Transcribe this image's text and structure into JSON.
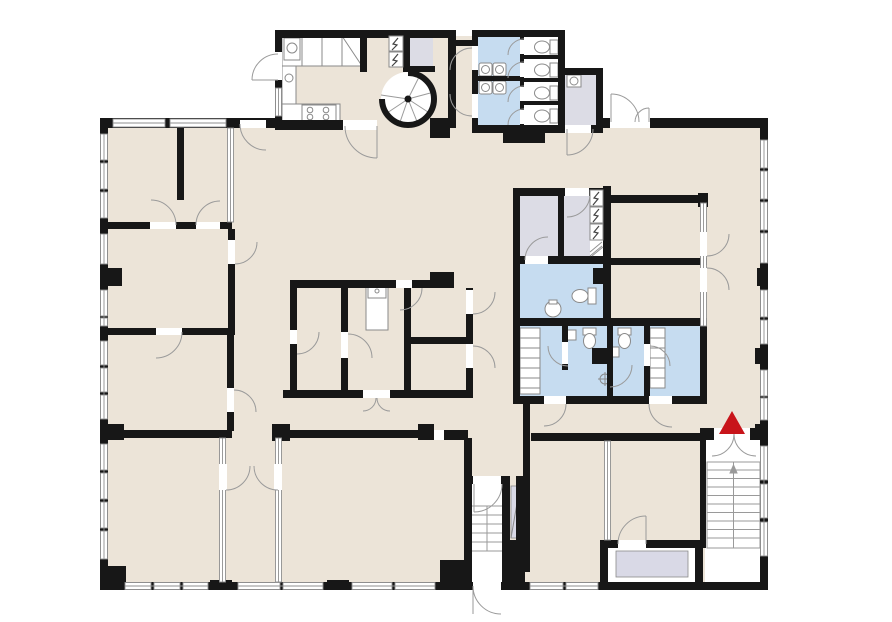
{
  "meta": {
    "title": "Building floor plan",
    "kind": "architectural-floor-plan",
    "width_px": 892,
    "height_px": 622
  },
  "colors": {
    "background": "#ffffff",
    "floor": "#ece4d8",
    "wall": "#171717",
    "wet": "#c6dcf0",
    "service": "#dcdce5",
    "mat": "#d9d9e6",
    "window_frame": "#8f8f8f",
    "door_swing": "#9a9a9a",
    "stair_line": "#9a9a9a",
    "fixture_line": "#8a8a8a",
    "marker": "#c8141a"
  },
  "legend": {
    "rooms": [
      {
        "id": "kitchen",
        "type": "kitchen",
        "fill_key": "floor"
      },
      {
        "id": "spiral-stair-hall",
        "type": "circulation",
        "fill_key": "floor"
      },
      {
        "id": "utility-closet-top",
        "type": "service",
        "fill_key": "service"
      },
      {
        "id": "washroom-a",
        "type": "wet-room",
        "fill_key": "wet"
      },
      {
        "id": "washroom-b",
        "type": "wet-room",
        "fill_key": "wet"
      },
      {
        "id": "wc-stalls",
        "type": "wc",
        "count": 4,
        "fill_key": "background"
      },
      {
        "id": "janitor-room",
        "type": "service",
        "fill_key": "service"
      },
      {
        "id": "offices-west",
        "type": "rooms",
        "fill_key": "floor"
      },
      {
        "id": "central-room-block",
        "type": "rooms",
        "fill_key": "floor"
      },
      {
        "id": "storage-a",
        "type": "service",
        "fill_key": "service"
      },
      {
        "id": "storage-b",
        "type": "service",
        "fill_key": "service"
      },
      {
        "id": "wc-room-central",
        "type": "wet-room",
        "fill_key": "wet"
      },
      {
        "id": "shower-suite",
        "type": "wet-room",
        "fill_key": "wet"
      },
      {
        "id": "main-hall",
        "type": "open-space",
        "fill_key": "floor"
      },
      {
        "id": "south-rooms",
        "type": "rooms",
        "fill_key": "floor"
      },
      {
        "id": "entry-vestibule",
        "type": "circulation",
        "fill_key": "background"
      },
      {
        "id": "elevator-room",
        "type": "service",
        "fill_key": "background"
      },
      {
        "id": "main-stairwell",
        "type": "circulation",
        "fill_key": "background"
      }
    ],
    "symbols": [
      {
        "id": "entrance-marker",
        "shape": "triangle",
        "color_key": "marker"
      },
      {
        "id": "spiral-staircase",
        "shape": "spiral-stair"
      },
      {
        "id": "main-stairs",
        "shape": "straight-stair"
      },
      {
        "id": "vestibule-stairs",
        "shape": "straight-stair"
      },
      {
        "id": "electrical-panel",
        "shape": "lightning-bolt",
        "count": 5
      },
      {
        "id": "toilet",
        "count": 7
      },
      {
        "id": "washbasin",
        "count": 9
      },
      {
        "id": "floor-drain",
        "count": 1
      },
      {
        "id": "stove",
        "burners": 4
      },
      {
        "id": "window",
        "style": "double-line"
      },
      {
        "id": "door",
        "style": "quarter-arc"
      }
    ]
  }
}
